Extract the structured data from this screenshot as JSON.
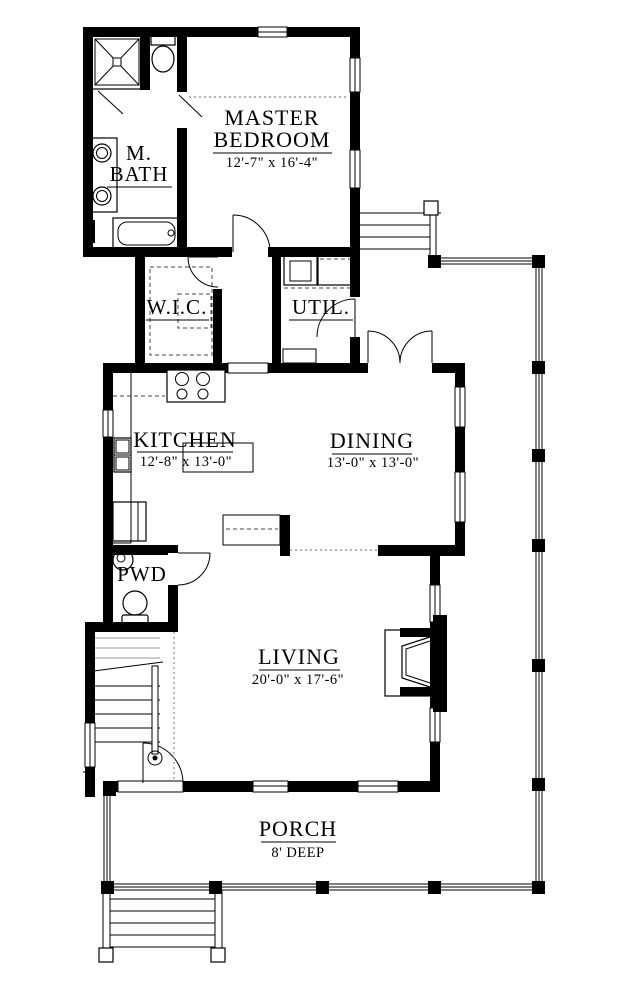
{
  "plan": {
    "title": "First floor plan",
    "colors": {
      "line": "#000000",
      "background": "#ffffff"
    },
    "rooms": {
      "master": {
        "line1": "MASTER",
        "line2": "BEDROOM",
        "dims": "12'-7\" x 16'-4\""
      },
      "mbath": {
        "line1": "M.",
        "line2": "BATH"
      },
      "wic": {
        "name": "W.I.C."
      },
      "util": {
        "name": "UTIL."
      },
      "kitchen": {
        "name": "KITCHEN",
        "dims": "12'-8\" x 13'-0\""
      },
      "dining": {
        "name": "DINING",
        "dims": "13'-0\" x 13'-0\""
      },
      "pwd": {
        "name": "PWD"
      },
      "living": {
        "name": "LIVING",
        "dims": "20'-0\" x 17'-6\""
      },
      "porch": {
        "name": "PORCH",
        "depth": "8' DEEP"
      }
    }
  }
}
